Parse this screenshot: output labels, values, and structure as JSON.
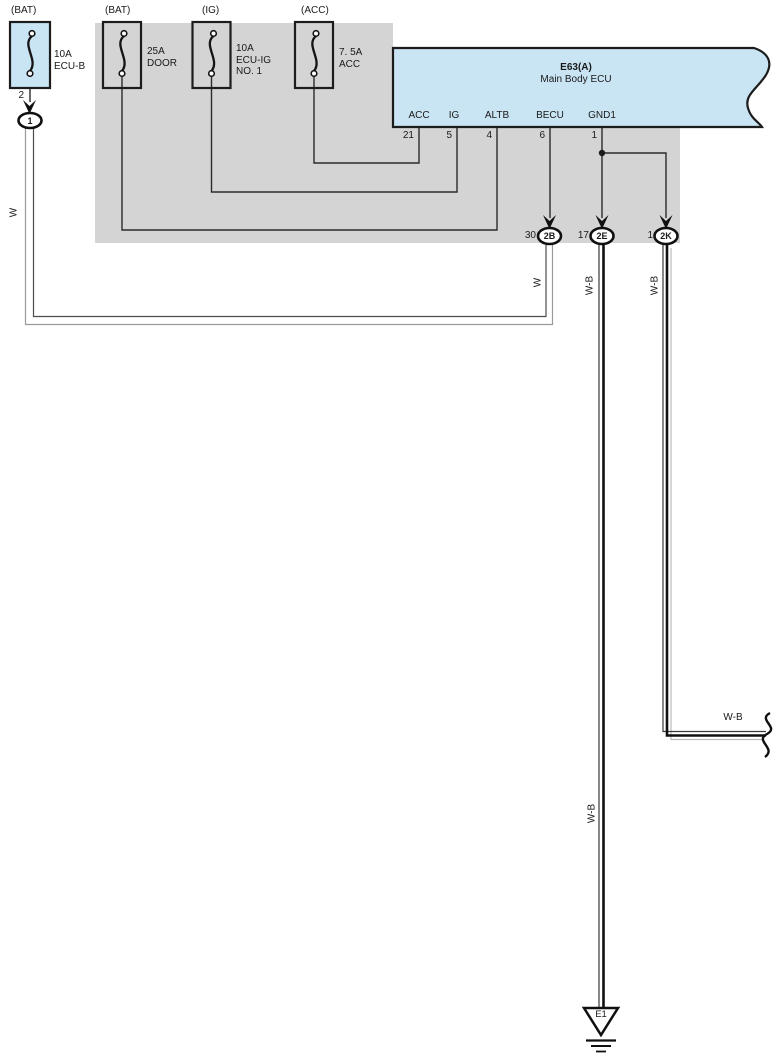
{
  "fuses": [
    {
      "tag": "(BAT)",
      "lines": [
        "10A",
        "ECU-B"
      ]
    },
    {
      "tag": "(BAT)",
      "lines": [
        "25A",
        "DOOR"
      ]
    },
    {
      "tag": "(IG)",
      "lines": [
        "10A",
        "ECU-IG",
        "NO. 1"
      ]
    },
    {
      "tag": "(ACC)",
      "lines": [
        "7. 5A",
        "ACC"
      ]
    }
  ],
  "ecu": {
    "code": "E63(A)",
    "name": "Main Body ECU",
    "pins": [
      {
        "label": "ACC",
        "number": "21"
      },
      {
        "label": "IG",
        "number": "5"
      },
      {
        "label": "ALTB",
        "number": "4"
      },
      {
        "label": "BECU",
        "number": "6"
      },
      {
        "label": "GND1",
        "number": "1"
      }
    ]
  },
  "connectors": {
    "fuse_out_pin": "2",
    "c1": {
      "id": "1"
    },
    "c2b": {
      "pin": "30",
      "id": "2B"
    },
    "c2e": {
      "pin": "17",
      "id": "2E"
    },
    "c2k": {
      "pin": "1",
      "id": "2K"
    }
  },
  "wire_labels": {
    "w_left": "W",
    "w_right": "W",
    "wb_2e_upper": "W-B",
    "wb_2k_upper": "W-B",
    "wb_2e_lower": "W-B",
    "wb_2k_branch": "W-B"
  },
  "ground": {
    "id": "E1"
  },
  "colors": {
    "ecu_fill": "#c9e4f3",
    "fuse1_fill": "#c9e4f3",
    "panel": "#d4d4d4",
    "line": "#1c1c1c"
  }
}
